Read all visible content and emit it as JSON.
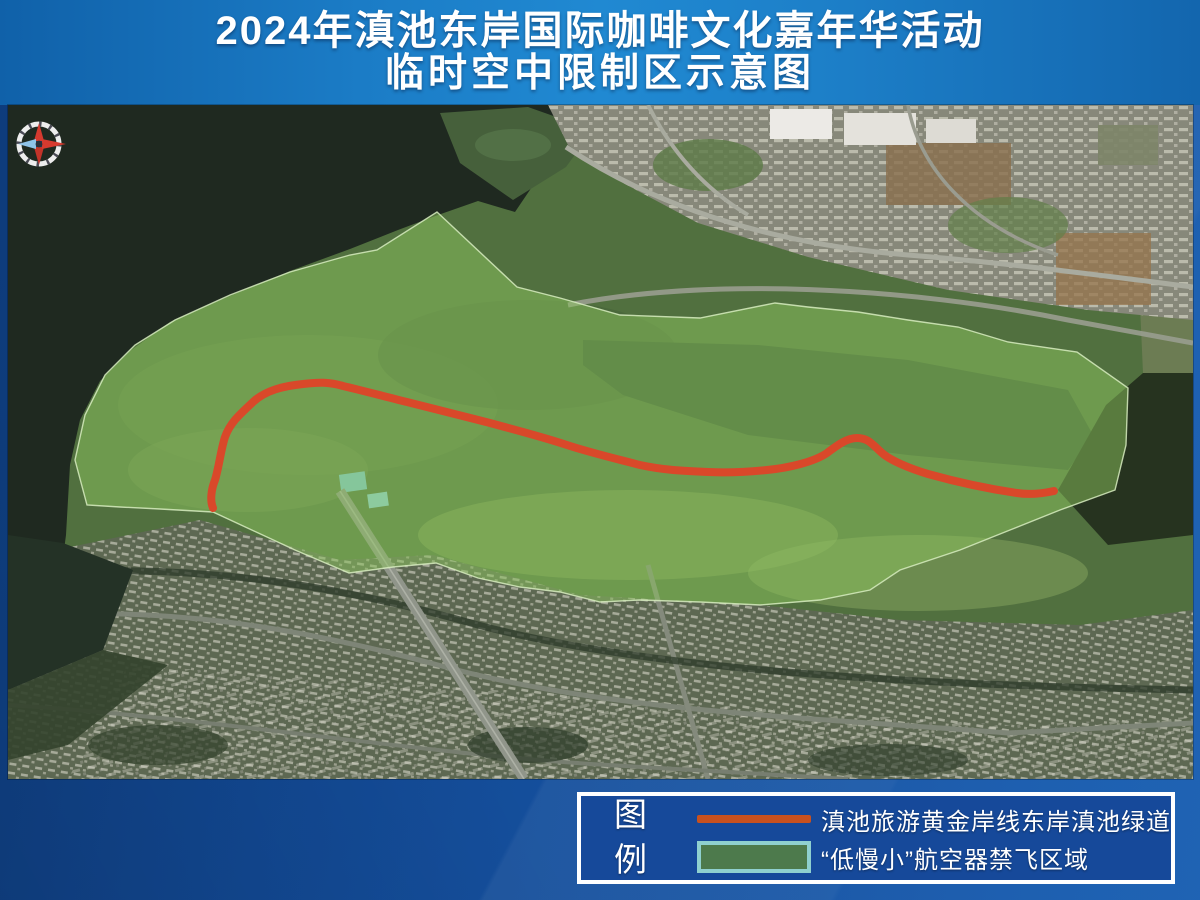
{
  "title": {
    "line1": "2024年滇池东岸国际咖啡文化嘉年华活动",
    "line2": "临时空中限制区示意图"
  },
  "map": {
    "compass_icon": "compass-rose",
    "no_fly_zone": {
      "label": "“低慢小”航空器禁飞区域",
      "fill_color": "#8cc45e"
    },
    "greenway": {
      "label": "滇池旅游黄金岸线东岸滇池绿道",
      "color": "#d9482a"
    }
  },
  "legend": {
    "heading": {
      "char1": "图",
      "char2": "例"
    },
    "items": [
      {
        "type": "line",
        "color": "#c8511f",
        "label": "滇池旅游黄金岸线东岸滇池绿道"
      },
      {
        "type": "area",
        "fill": "#4d7a4c",
        "border": "#8fd0cf",
        "label": "“低慢小”航空器禁飞区域"
      }
    ]
  },
  "colors": {
    "page_background": "#15509e",
    "title_background": "#2089d2",
    "legend_background": "#16499a",
    "lake_water": "#1f2920",
    "wetland_green": "#51703f"
  }
}
